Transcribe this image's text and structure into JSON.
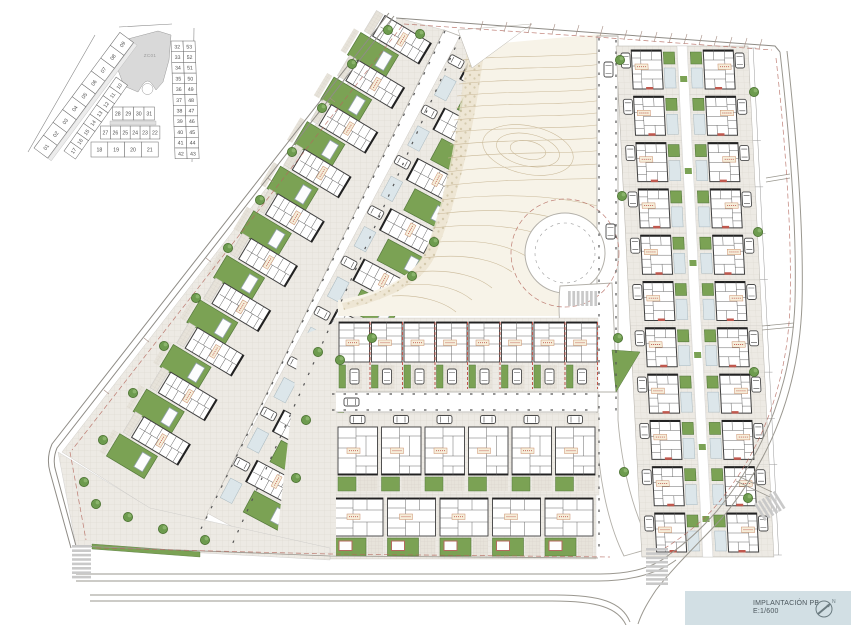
{
  "title_block": {
    "title": "IMPLANTACIÓN PB",
    "scale": "E:1/600",
    "north_label": "N"
  },
  "key_plan": {
    "zone_label": "ZC01",
    "left_strip": [
      "01",
      "02",
      "03",
      "04",
      "05",
      "06",
      "07",
      "08",
      "09"
    ],
    "middle_strip": [
      "17",
      "16",
      "15",
      "14",
      "13",
      "12",
      "11",
      "10"
    ],
    "row_top": [
      "28",
      "29",
      "30",
      "31"
    ],
    "row_mid": [
      "27",
      "26",
      "25",
      "24",
      "23",
      "22"
    ],
    "row_bottom": [
      "18",
      "19",
      "20",
      "21"
    ],
    "right_pairs": [
      [
        "32",
        "53"
      ],
      [
        "33",
        "52"
      ],
      [
        "34",
        "51"
      ],
      [
        "35",
        "50"
      ],
      [
        "36",
        "49"
      ],
      [
        "37",
        "48"
      ],
      [
        "38",
        "47"
      ],
      [
        "39",
        "46"
      ],
      [
        "40",
        "45"
      ],
      [
        "41",
        "44"
      ],
      [
        "42",
        "43"
      ]
    ]
  },
  "legend_colors": {
    "garden_green": "#7ba254",
    "paving_gray": "#edeae4",
    "contour_tan": "#c9b897",
    "park_cream": "#f7f3e8",
    "setback_red": "#b4695e",
    "pool_patio_blue": "#dce6ea",
    "road_edge": "#b3b0a9",
    "building_line": "#3f3f3f",
    "title_block_bg": "#d2dfe4",
    "key_plan_zone_gray": "#d9d9d9"
  }
}
